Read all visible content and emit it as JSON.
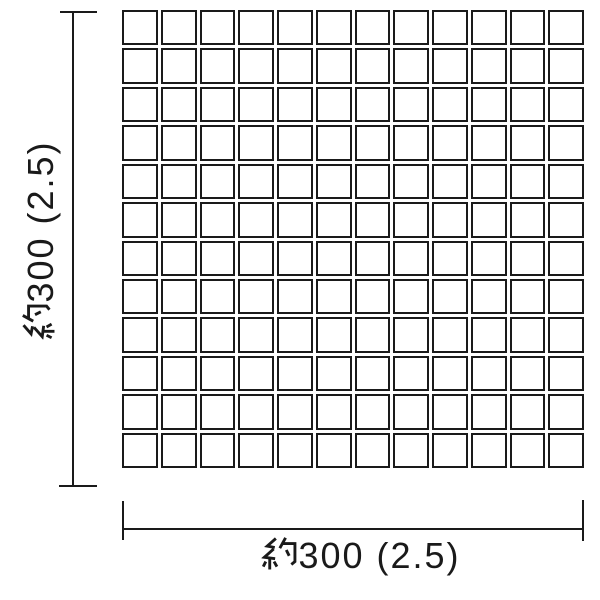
{
  "grid": {
    "rows": 12,
    "cols": 12,
    "tile_shape": "square"
  },
  "dimensions": {
    "vertical": {
      "label": "約300 (2.5)",
      "kanji_prefix": "約",
      "value_text": "300 (2.5)"
    },
    "horizontal": {
      "label": "約300 (2.5)",
      "kanji_prefix": "約",
      "value_text": "300 (2.5)"
    }
  },
  "icons": {
    "kanji_yaku": "約"
  },
  "colors": {
    "line": "#1a1a1a",
    "background": "#ffffff"
  }
}
